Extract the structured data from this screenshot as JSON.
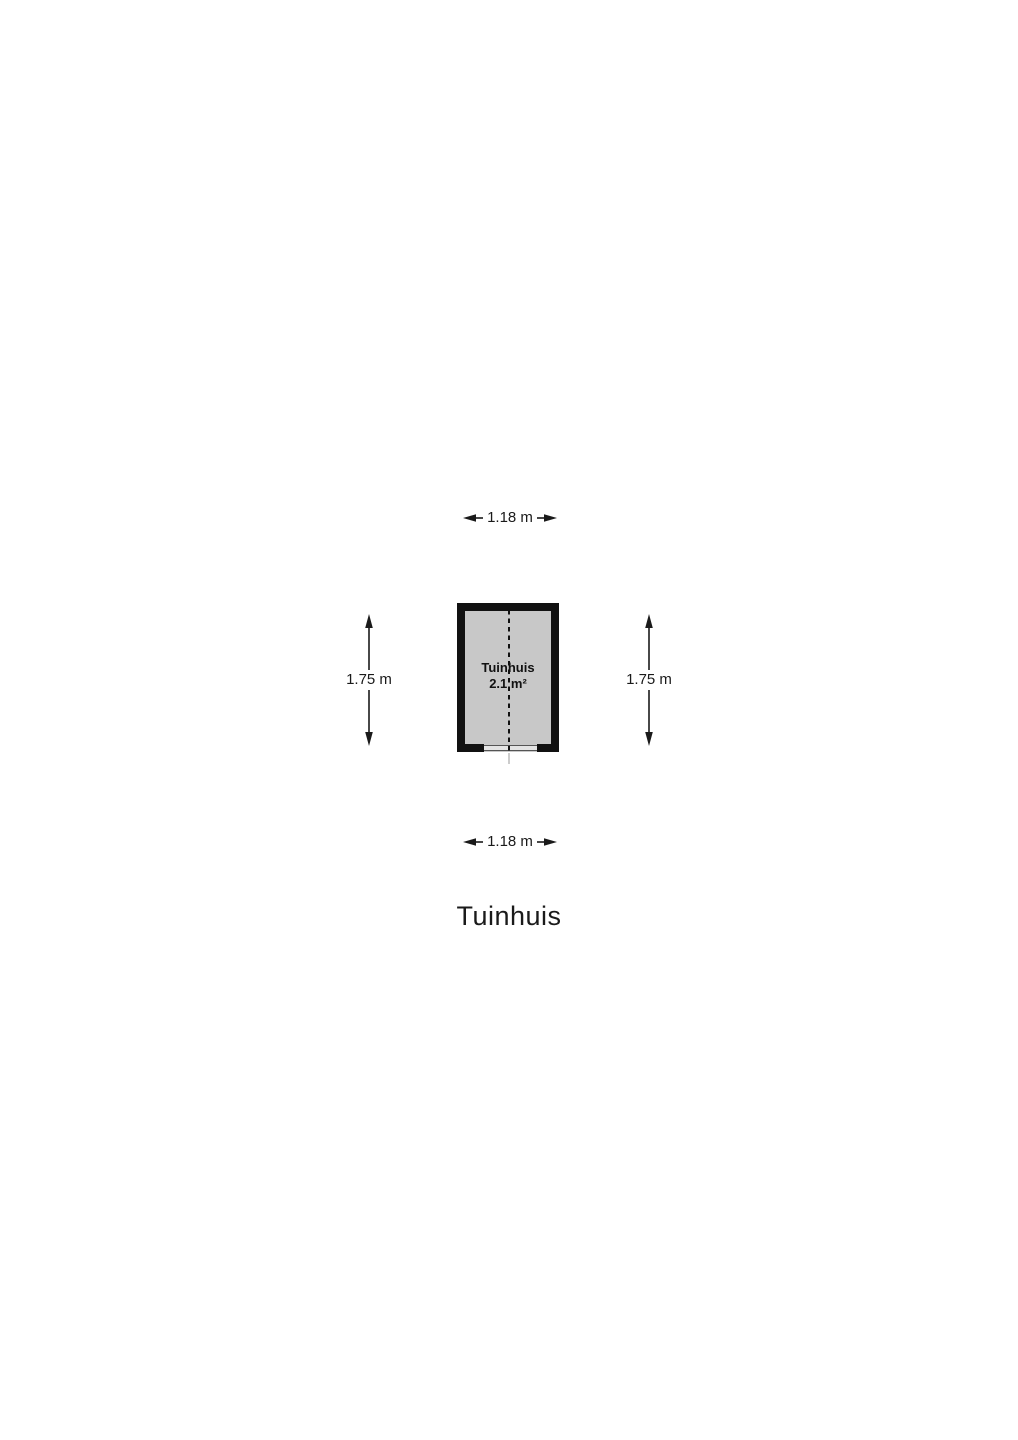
{
  "page": {
    "title": "Tuinhuis"
  },
  "floorplan": {
    "room": {
      "name": "Tuinhuis",
      "area": "2.1 m²"
    },
    "dimensions": {
      "top": "1.18 m",
      "bottom": "1.18 m",
      "left": "1.75 m",
      "right": "1.75 m"
    },
    "colors": {
      "wall": "#111111",
      "room_fill": "#c8c8c8",
      "door_sill": "#e4e4e4",
      "text": "#1a1a1a",
      "background": "#ffffff"
    }
  }
}
